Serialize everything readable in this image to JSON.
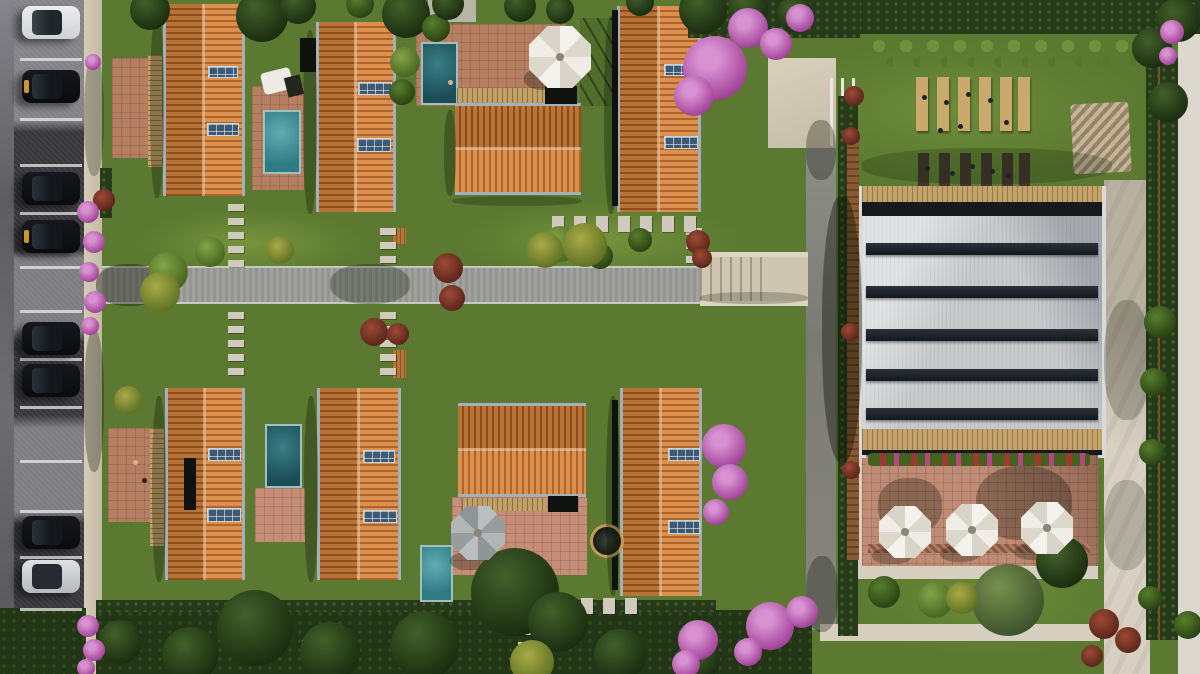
{
  "description": "Aerial top-down 3D rendering of a residential villa complex: street parking with cars on the left, two rows of terracotta gable-roofed villas with rooftop solar panels, private pools and terracotta patios, a central concrete walkway with stepping-stone paths, pink bougainvillea, a clubhouse with a white ribbed roof and skylight bands, an umbrella dining terrace, picnic tables on a lawn, and perimeter hedges and paths.",
  "palette": {
    "grass": "#5b7930",
    "hedge": "#26391a",
    "road": "#9c9c98",
    "asphalt": "#3a3a3e",
    "sidewalk": "#cdc4ae",
    "beige_path": "#d6cfc0",
    "roof_tile_light": "#d98a42",
    "roof_tile_dark": "#a95a21",
    "roof_edge_steel": "#a3b0ba",
    "solar_panel": "#3d5a74",
    "pool_bright": "#4f9da6",
    "pool_deep": "#27616b",
    "patio_terracotta": "#b67f63",
    "patio_pink": "#c68d77",
    "wood_tan": "#c4a26a",
    "wood_wall": "#8a5a33",
    "club_roof": "#c8cacc",
    "skylight_band": "#1d2227",
    "umbrella_canvas": "#f2f0e9",
    "bougainvillea": "#bb6cb4",
    "rust_bush": "#8f3d2c",
    "car_black": "#0d0e12",
    "car_white": "#e6e7e8"
  },
  "scene": {
    "stall_line_ys": [
      58,
      118,
      164,
      212,
      266,
      310,
      358,
      406,
      460,
      510,
      556,
      608
    ],
    "cars": [
      {
        "y": 6,
        "c": "white"
      },
      {
        "y": 70,
        "c": "black",
        "accent": true
      },
      {
        "y": 172,
        "c": "black"
      },
      {
        "y": 220,
        "c": "black",
        "accent": true
      },
      {
        "y": 322,
        "c": "black"
      },
      {
        "y": 364,
        "c": "black"
      },
      {
        "y": 516,
        "c": "black"
      },
      {
        "y": 560,
        "c": "silver"
      }
    ],
    "houses": [
      [
        163,
        4,
        82,
        192,
        "v"
      ],
      [
        316,
        22,
        80,
        190,
        "v"
      ],
      [
        617,
        6,
        84,
        206,
        "v"
      ],
      [
        455,
        103,
        126,
        92,
        "h"
      ],
      [
        165,
        388,
        80,
        192,
        "v"
      ],
      [
        317,
        388,
        84,
        192,
        "v"
      ],
      [
        620,
        388,
        82,
        208,
        "v"
      ],
      [
        458,
        403,
        128,
        94,
        "h"
      ]
    ],
    "panels": [
      [
        208,
        66,
        30,
        12
      ],
      [
        207,
        123,
        32,
        13
      ],
      [
        358,
        82,
        34,
        13
      ],
      [
        357,
        138,
        34,
        14
      ],
      [
        664,
        64,
        33,
        12
      ],
      [
        664,
        136,
        34,
        13
      ],
      [
        208,
        448,
        33,
        13
      ],
      [
        207,
        508,
        34,
        14
      ],
      [
        363,
        450,
        32,
        13
      ],
      [
        363,
        510,
        34,
        13
      ],
      [
        668,
        448,
        32,
        13
      ],
      [
        668,
        520,
        32,
        14
      ]
    ],
    "pools": [
      [
        263,
        110,
        38,
        64,
        "bright"
      ],
      [
        421,
        42,
        37,
        63,
        "deep"
      ],
      [
        265,
        424,
        37,
        64,
        "deep"
      ],
      [
        420,
        545,
        33,
        57,
        "bright"
      ]
    ],
    "patios": [
      [
        112,
        58,
        40,
        98
      ],
      [
        112,
        118,
        54,
        40
      ],
      [
        252,
        86,
        52,
        104
      ],
      [
        416,
        24,
        150,
        82
      ],
      [
        108,
        428,
        56,
        94
      ],
      [
        255,
        488,
        50,
        54,
        "pink"
      ],
      [
        452,
        497,
        135,
        78,
        "pink"
      ]
    ],
    "pergolas": [
      [
        148,
        55,
        14,
        112,
        "v"
      ],
      [
        150,
        428,
        14,
        118,
        "v"
      ],
      [
        186,
        430,
        14,
        100,
        "v"
      ],
      [
        457,
        88,
        88,
        15,
        "h"
      ],
      [
        462,
        498,
        84,
        13,
        "h"
      ]
    ],
    "planters": [
      [
        392,
        228,
        14,
        16
      ],
      [
        392,
        350,
        14,
        28
      ]
    ],
    "dark_structures": [
      [
        300,
        38,
        16,
        34
      ],
      [
        545,
        86,
        32,
        18
      ],
      [
        548,
        496,
        30,
        16
      ],
      [
        184,
        458,
        12,
        52
      ],
      [
        612,
        10,
        6,
        196
      ],
      [
        612,
        400,
        6,
        190
      ]
    ],
    "stones": [
      {
        "x": 228,
        "y": 204,
        "n": 5,
        "d": "v"
      },
      {
        "x": 380,
        "y": 228,
        "n": 3,
        "d": "v"
      },
      {
        "x": 228,
        "y": 312,
        "n": 5,
        "d": "v"
      },
      {
        "x": 380,
        "y": 312,
        "n": 5,
        "d": "v"
      },
      {
        "x": 686,
        "y": 228,
        "n": 3,
        "d": "v"
      },
      {
        "x": 552,
        "y": 216,
        "n": 7,
        "d": "h"
      },
      {
        "x": 537,
        "y": 598,
        "n": 5,
        "d": "h"
      },
      {
        "x": 518,
        "y": 628,
        "n": 2,
        "d": "v"
      },
      {
        "x": 302,
        "y": 640,
        "n": 2,
        "d": "v"
      }
    ],
    "building": {
      "band_ys": [
        243,
        286,
        329,
        369,
        408
      ]
    },
    "picnic": {
      "light_xs": [
        916,
        937,
        958,
        979,
        1000,
        1018
      ],
      "dark_xs": [
        918,
        939,
        960,
        981,
        1002,
        1019
      ]
    },
    "people": [
      [
        922,
        95
      ],
      [
        944,
        100
      ],
      [
        966,
        92
      ],
      [
        988,
        98
      ],
      [
        1004,
        120
      ],
      [
        938,
        128
      ],
      [
        958,
        124
      ],
      [
        925,
        166
      ],
      [
        950,
        171
      ],
      [
        970,
        164
      ],
      [
        990,
        169
      ],
      [
        1006,
        173
      ],
      [
        448,
        80,
        "tan"
      ],
      [
        133,
        460,
        "tan"
      ],
      [
        142,
        478
      ]
    ],
    "trees": [
      [
        150,
        10,
        20,
        "dark"
      ],
      [
        262,
        16,
        26,
        "dark"
      ],
      [
        298,
        6,
        18,
        "dark"
      ],
      [
        360,
        4,
        14,
        "mid"
      ],
      [
        406,
        14,
        24,
        "dark"
      ],
      [
        436,
        28,
        14,
        "mid"
      ],
      [
        448,
        4,
        16,
        "dark"
      ],
      [
        520,
        6,
        16,
        "dark"
      ],
      [
        560,
        10,
        14,
        "dark"
      ],
      [
        640,
        2,
        14,
        "dark"
      ],
      [
        703,
        10,
        24,
        "dark"
      ],
      [
        748,
        8,
        20,
        "dark"
      ],
      [
        795,
        14,
        18,
        "dark"
      ],
      [
        168,
        272,
        20,
        "light"
      ],
      [
        210,
        252,
        15,
        "light"
      ],
      [
        560,
        244,
        18,
        "light"
      ],
      [
        600,
        256,
        13,
        "mid"
      ],
      [
        640,
        240,
        12,
        "mid"
      ],
      [
        515,
        592,
        44,
        "dark"
      ],
      [
        558,
        622,
        30,
        "dark"
      ],
      [
        255,
        628,
        38,
        "dark"
      ],
      [
        190,
        655,
        28,
        "dark"
      ],
      [
        330,
        652,
        30,
        "dark"
      ],
      [
        425,
        645,
        34,
        "dark"
      ],
      [
        620,
        655,
        26,
        "dark"
      ],
      [
        120,
        642,
        22,
        "dark"
      ],
      [
        700,
        660,
        20,
        "dark"
      ],
      [
        405,
        62,
        15,
        "light"
      ],
      [
        402,
        92,
        13,
        "mid"
      ],
      [
        1008,
        600,
        36,
        "olive"
      ],
      [
        1062,
        562,
        26,
        "dark"
      ],
      [
        884,
        592,
        16,
        "mid"
      ],
      [
        935,
        600,
        18,
        "light"
      ],
      [
        1160,
        322,
        16,
        "mid"
      ],
      [
        1154,
        382,
        14,
        "mid"
      ],
      [
        1152,
        452,
        13,
        "mid"
      ],
      [
        1168,
        102,
        20,
        "dark"
      ],
      [
        1152,
        48,
        20,
        "dark"
      ],
      [
        1178,
        20,
        22,
        "dark"
      ],
      [
        1188,
        625,
        14,
        "mid"
      ],
      [
        1150,
        598,
        12,
        "mid"
      ]
    ],
    "red_bushes": [
      [
        448,
        268,
        15
      ],
      [
        452,
        298,
        13
      ],
      [
        374,
        332,
        14
      ],
      [
        398,
        334,
        11
      ],
      [
        104,
        200,
        11
      ],
      [
        698,
        242,
        12
      ],
      [
        702,
        258,
        10
      ],
      [
        854,
        96,
        10
      ],
      [
        851,
        136,
        9
      ],
      [
        850,
        332,
        9
      ],
      [
        851,
        470,
        9
      ],
      [
        1104,
        624,
        15
      ],
      [
        1128,
        640,
        13
      ],
      [
        1092,
        656,
        11
      ]
    ],
    "yellow_bushes": [
      [
        585,
        245,
        22
      ],
      [
        545,
        250,
        18
      ],
      [
        160,
        292,
        20
      ],
      [
        280,
        250,
        14
      ],
      [
        962,
        598,
        16
      ],
      [
        532,
        662,
        22
      ],
      [
        128,
        400,
        14
      ]
    ],
    "pink_flowers": [
      [
        715,
        68,
        32
      ],
      [
        694,
        96,
        20
      ],
      [
        748,
        28,
        20
      ],
      [
        776,
        44,
        16
      ],
      [
        800,
        18,
        14
      ],
      [
        724,
        446,
        22
      ],
      [
        730,
        482,
        18
      ],
      [
        716,
        512,
        13
      ],
      [
        698,
        640,
        20
      ],
      [
        686,
        664,
        14
      ],
      [
        770,
        626,
        24
      ],
      [
        802,
        612,
        16
      ],
      [
        748,
        652,
        14
      ],
      [
        88,
        212,
        11
      ],
      [
        94,
        242,
        11
      ],
      [
        89,
        272,
        10
      ],
      [
        95,
        302,
        11
      ],
      [
        90,
        326,
        9
      ],
      [
        93,
        62,
        8
      ],
      [
        88,
        626,
        11
      ],
      [
        94,
        650,
        11
      ],
      [
        86,
        668,
        9
      ],
      [
        1172,
        32,
        12
      ],
      [
        1168,
        56,
        9
      ]
    ],
    "umbrellas": [
      {
        "cx": 560,
        "cy": 57,
        "r": 31,
        "c": "white"
      },
      {
        "cx": 478,
        "cy": 533,
        "r": 27,
        "c": "gray"
      },
      {
        "cx": 905,
        "cy": 532,
        "r": 26,
        "c": "white"
      },
      {
        "cx": 972,
        "cy": 530,
        "r": 26,
        "c": "white"
      },
      {
        "cx": 1047,
        "cy": 528,
        "r": 26,
        "c": "white"
      }
    ],
    "shadows": [
      [
        96,
        264,
        66,
        42,
        0.38
      ],
      [
        330,
        264,
        80,
        40,
        0.28
      ],
      [
        700,
        292,
        108,
        12,
        0.22
      ],
      [
        150,
        14,
        14,
        184,
        0.3
      ],
      [
        303,
        30,
        14,
        184,
        0.3
      ],
      [
        604,
        16,
        14,
        198,
        0.3
      ],
      [
        152,
        396,
        14,
        186,
        0.3
      ],
      [
        304,
        396,
        14,
        186,
        0.3
      ],
      [
        606,
        396,
        14,
        200,
        0.3
      ],
      [
        444,
        110,
        12,
        86,
        0.3
      ],
      [
        452,
        196,
        130,
        10,
        0.25
      ],
      [
        822,
        196,
        40,
        266,
        0.4
      ],
      [
        806,
        120,
        30,
        60,
        0.3
      ],
      [
        806,
        556,
        32,
        76,
        0.3
      ],
      [
        524,
        68,
        42,
        22,
        0.3
      ],
      [
        450,
        552,
        38,
        18,
        0.3
      ],
      [
        872,
        548,
        40,
        16,
        0.28
      ],
      [
        940,
        546,
        40,
        16,
        0.28
      ],
      [
        1014,
        544,
        40,
        16,
        0.28
      ],
      [
        878,
        478,
        64,
        56,
        0.3
      ],
      [
        976,
        466,
        96,
        74,
        0.3
      ],
      [
        862,
        148,
        250,
        36,
        0.2
      ],
      [
        84,
        56,
        20,
        120,
        0.25
      ],
      [
        84,
        330,
        20,
        142,
        0.3
      ],
      [
        1104,
        300,
        46,
        120,
        0.22
      ],
      [
        1104,
        480,
        46,
        90,
        0.18
      ]
    ]
  }
}
